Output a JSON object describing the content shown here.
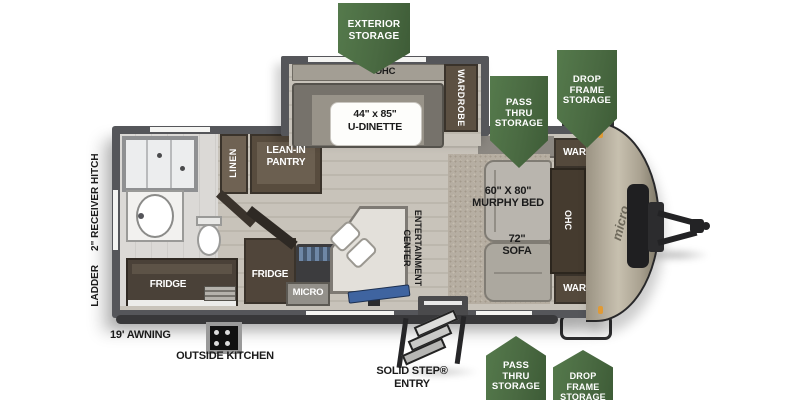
{
  "colors": {
    "badge_green": "#4a6a42",
    "wall_gray": "#55565a",
    "floor_wood": "#c8c3ba",
    "cap_champagne": "#b3ab99",
    "tv_blue": "#3f64a0",
    "marker_orange": "#e09a35"
  },
  "badges": {
    "exterior_storage": {
      "lines": [
        "EXTERIOR",
        "STORAGE"
      ]
    },
    "pass_thru_top": {
      "lines": [
        "PASS",
        "THRU",
        "STORAGE"
      ]
    },
    "drop_frame_top": {
      "lines": [
        "DROP",
        "FRAME",
        "STORAGE"
      ]
    },
    "pass_thru_bottom": {
      "lines": [
        "PASS",
        "THRU",
        "STORAGE"
      ]
    },
    "drop_frame_bottom": {
      "lines": [
        "DROP",
        "FRAME",
        "STORAGE"
      ]
    }
  },
  "interior": {
    "slide": {
      "ohc": "OHC",
      "wardrobe": "WARDROBE",
      "dinette_size": "44\" x 85\"",
      "dinette_name": "U-DINETTE"
    },
    "front": {
      "ward_top": "WARD",
      "ward_bottom": "WARD",
      "ohc": "OHC",
      "bed_size": "60\" X 80\"",
      "bed_name": "MURPHY BED",
      "sofa_size": "72\"",
      "sofa_name": "SOFA"
    },
    "bath": {
      "linen": "LINEN",
      "pantry": [
        "LEAN-IN",
        "PANTRY"
      ]
    },
    "kitchen": {
      "fridge_left": "FRIDGE",
      "fridge_right": "FRIDGE",
      "micro": "MICRO",
      "entertainment": [
        "ENTERTAINMENT",
        "CENTER"
      ]
    }
  },
  "exterior": {
    "awning": "19' AWNING",
    "outside_kitchen": "OUTSIDE KITCHEN",
    "solid_step": [
      "SOLID STEP®",
      "ENTRY"
    ],
    "ladder": "LADDER",
    "receiver_hitch": "2\" RECEIVER HITCH",
    "brand_logo": "micro"
  }
}
